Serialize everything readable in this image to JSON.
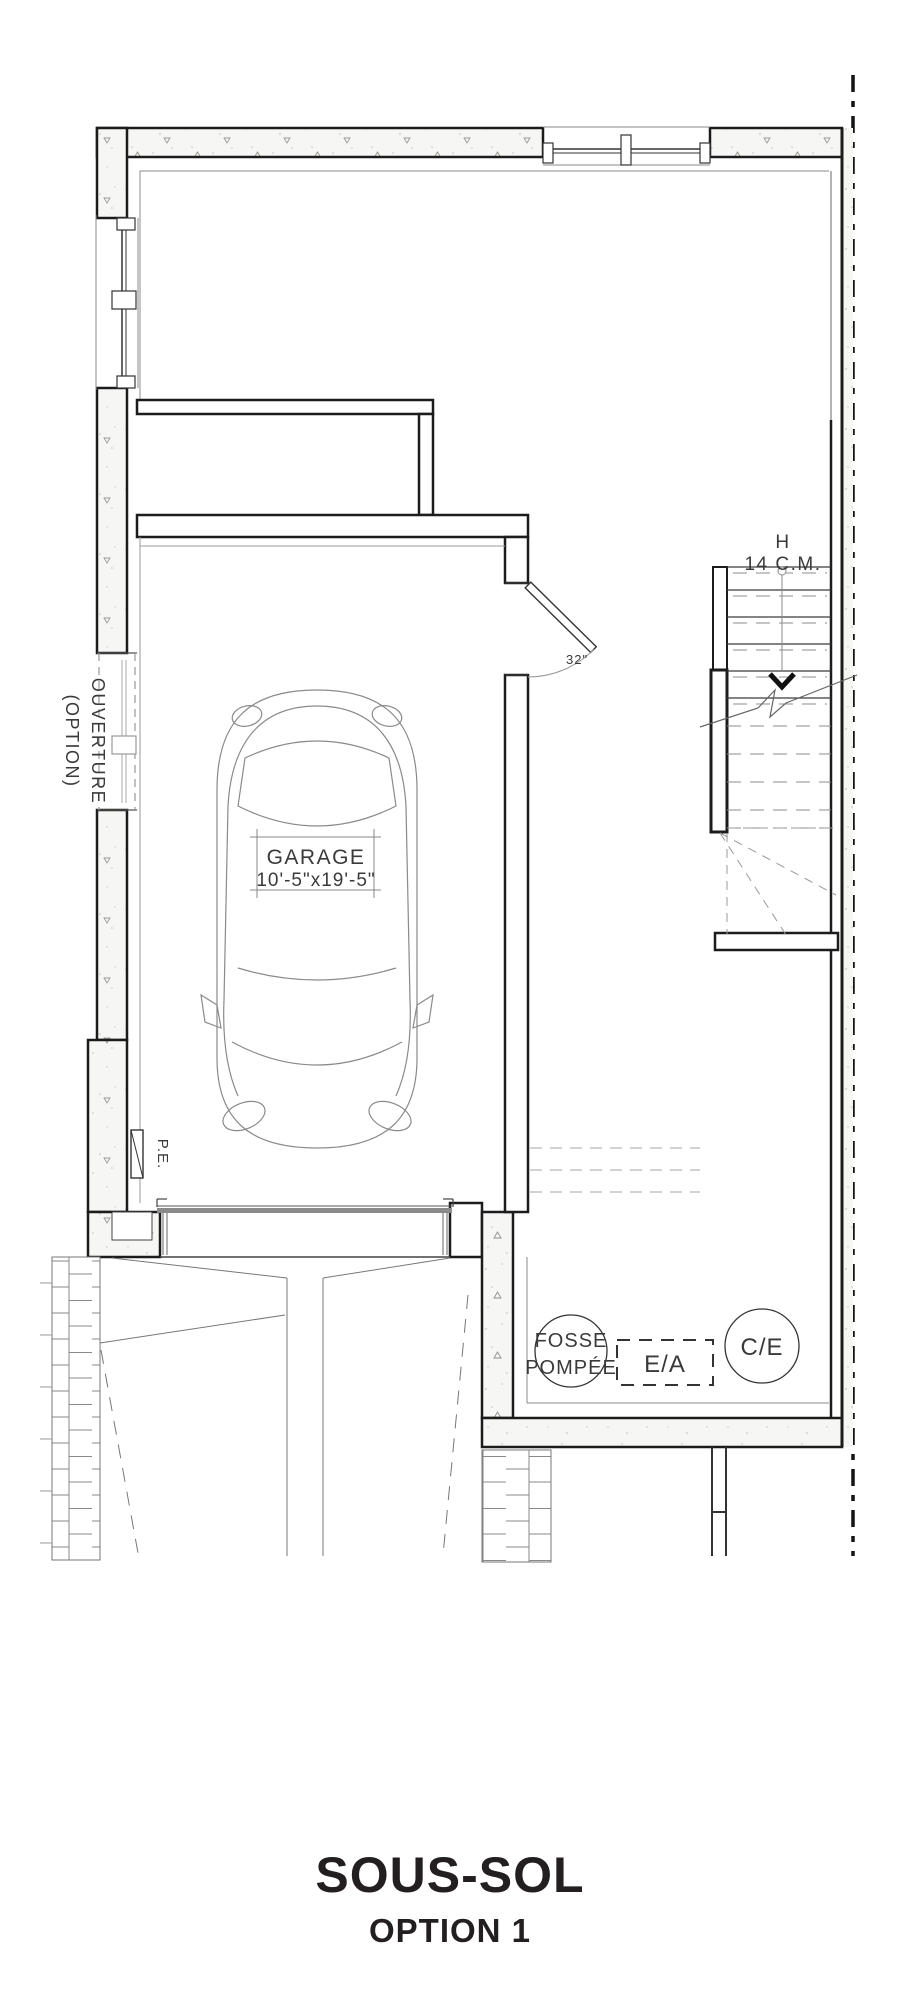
{
  "title": {
    "main": "SOUS-SOL",
    "sub": "OPTION 1"
  },
  "labels": {
    "garage_name": "GARAGE",
    "garage_dims": "10'-5\"x19'-5\"",
    "stairs_h": "H",
    "stairs_risers": "14 C.M.",
    "ouverture1": "OUVERTURE",
    "ouverture2": "(OPTION)",
    "pe": "P.E.",
    "door_width": "32\"",
    "fosse1": "FOSSE",
    "fosse2": "POMPÉE",
    "ea": "E/A",
    "ce": "C/E"
  },
  "colors": {
    "ink": "#1c1c1c",
    "thin_line": "#777777",
    "dashed_line": "#999999",
    "text": "#3a3a3a",
    "background": "#ffffff"
  }
}
